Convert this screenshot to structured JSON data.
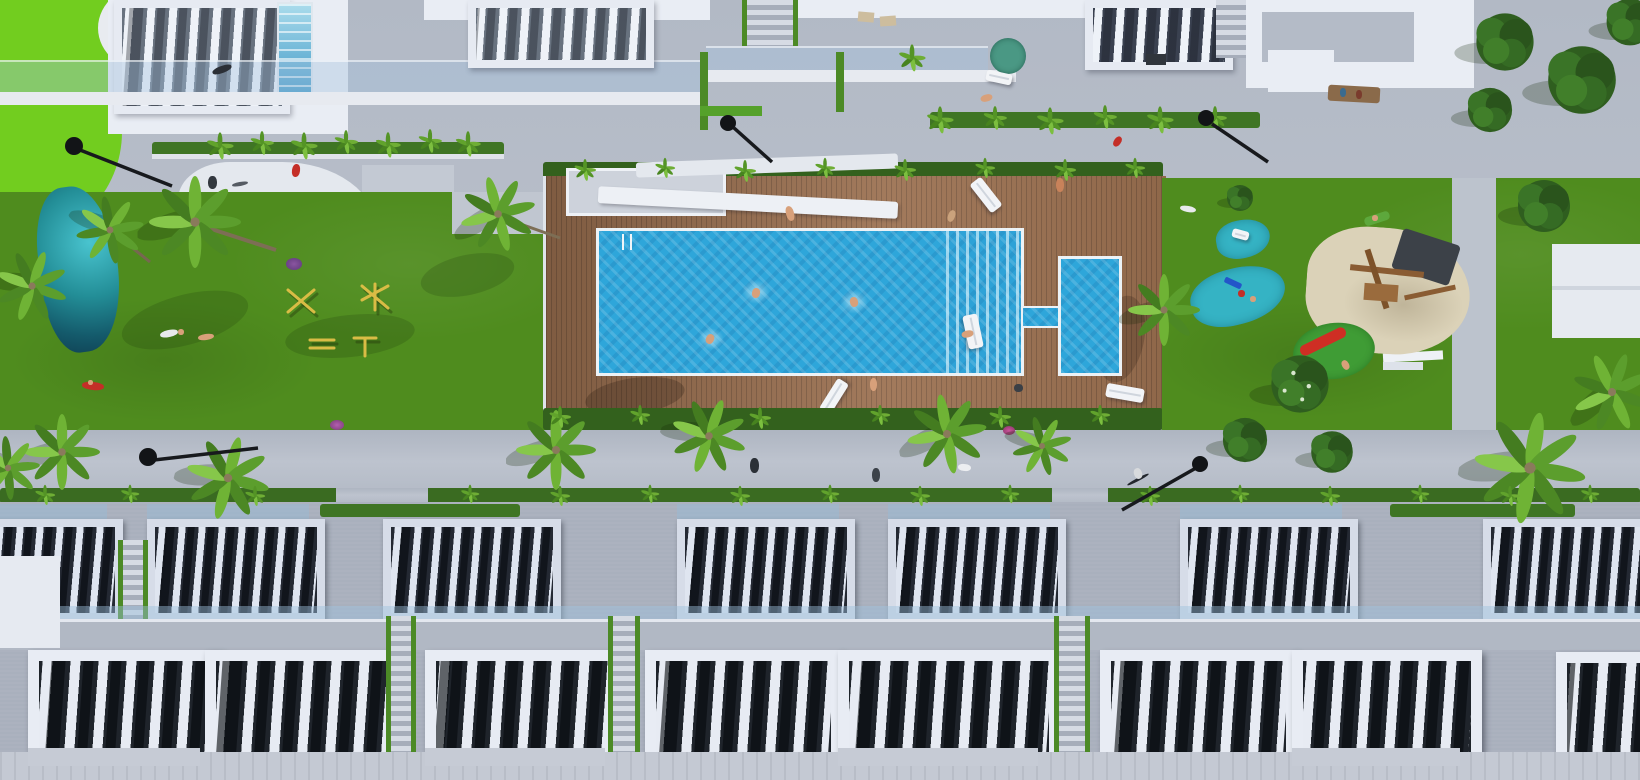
{
  "scene": {
    "type": "aerial-architectural-render",
    "description": "Bird's-eye 3D rendering of a residential development: large communal swimming pool and kids pool on a timber sun deck, lawns with outdoor gym, splash pads and sand playground, palm-lined promenade, apartment terraces with slatted pergolas at top and two rows of white townhouses with rooftop pergolas at the bottom.",
    "time_of_day": "midday",
    "style": "CGI marketing visual"
  },
  "palette": {
    "grass": "#4f8c1e",
    "bright_turf": "#72cd1f",
    "pool_water": "#2ea6da",
    "splash_pad_water": "#35b3c4",
    "deck_wood": "#9b7050",
    "paving": "#b7bec9",
    "building_white": "#e9edf4",
    "pergola_shadow": "#23272e",
    "hedge_green": "#3a6b21",
    "sand": "#dbd2b8",
    "lamp_black": "#16181c",
    "parasol_teal": "#4a9884",
    "slide_red": "#cf2e24",
    "gym_equipment_yellow": "#d9bc45",
    "pond_teal": "#238e97"
  },
  "inventory": {
    "main_pool": 1,
    "kids_pool": 1,
    "splash_pads": 2,
    "sun_loungers": 4,
    "pool_float": 1,
    "parasols": 1,
    "street_lamps": 5,
    "palm_trees": 13,
    "apartment_blocks": 4,
    "townhouse_pergolas_back_row": 7,
    "townhouse_pergolas_front_row": 8,
    "staircases": 5,
    "swimmers": 3,
    "playground_sand_pit": 1,
    "outdoor_gym_stations": 4,
    "garden_pond": 1
  }
}
